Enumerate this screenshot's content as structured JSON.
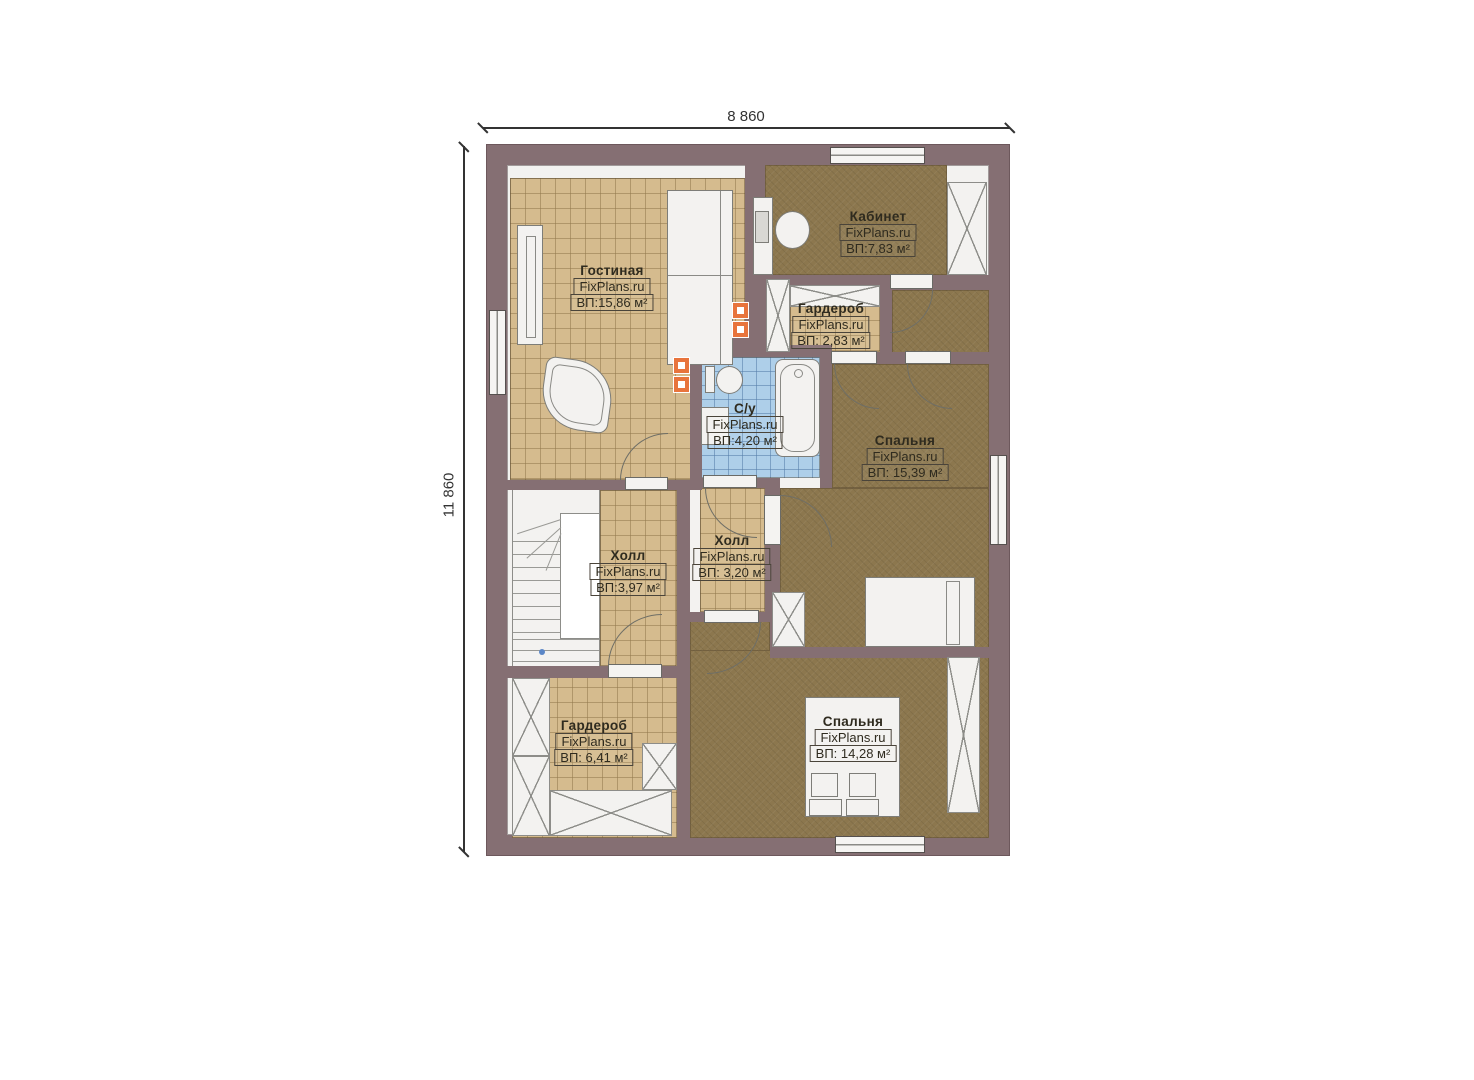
{
  "plan": {
    "brand": "FixPlans.ru",
    "dimensions": {
      "width_label": "8 860",
      "height_label": "11 860"
    },
    "rooms": [
      {
        "name": "Гостиная",
        "brand": "FixPlans.ru",
        "area": "ВП:15,86 м²"
      },
      {
        "name": "Кабинет",
        "brand": "FixPlans.ru",
        "area": "ВП:7,83 м²"
      },
      {
        "name": "Гардероб",
        "brand": "FixPlans.ru",
        "area": "ВП: 2,83 м²"
      },
      {
        "name": "С/у",
        "brand": "FixPlans.ru",
        "area": "ВП:4,20 м²"
      },
      {
        "name": "Спальня",
        "brand": "FixPlans.ru",
        "area": "ВП: 15,39 м²"
      },
      {
        "name": "Холл",
        "brand": "FixPlans.ru",
        "area": "ВП:3,97 м²"
      },
      {
        "name": "Холл",
        "brand": "FixPlans.ru",
        "area": "ВП: 3,20 м²"
      },
      {
        "name": "Гардероб",
        "brand": "FixPlans.ru",
        "area": "ВП: 6,41 м²"
      },
      {
        "name": "Спальня",
        "brand": "FixPlans.ru",
        "area": "ВП: 14,28 м²"
      }
    ],
    "colors": {
      "wall": "#856f73",
      "tile_beige": "#d5bb8e",
      "carpet_brown": "#8c774e",
      "tile_blue": "#aecfe9",
      "white": "#f3f2f0",
      "accent_orange": "#e8743c"
    }
  }
}
